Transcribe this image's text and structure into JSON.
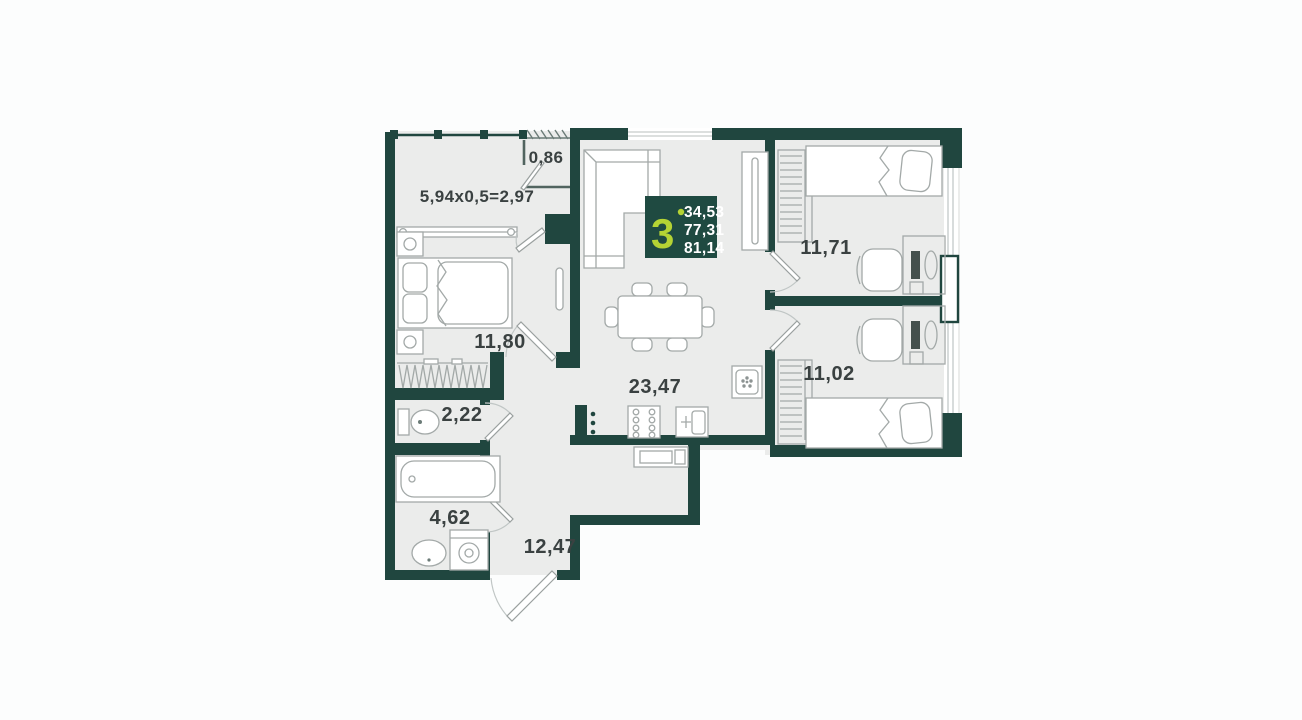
{
  "plan_title": "3-room apartment floor plan",
  "badge": {
    "rooms_count": "3",
    "areas": [
      "34,53",
      "77,31",
      "81,14"
    ]
  },
  "rooms": {
    "balcony": {
      "label": "5,94x0,5=2,97"
    },
    "storage": {
      "label": "0,86"
    },
    "bedroom": {
      "label": "11,80"
    },
    "wc": {
      "label": "2,22"
    },
    "bathroom": {
      "label": "4,62"
    },
    "hallway": {
      "label": "12,47"
    },
    "living_kitchen": {
      "label": "23,47"
    },
    "bedroom2": {
      "label": "11,71"
    },
    "bedroom3": {
      "label": "11,02"
    }
  },
  "colors": {
    "wall": "#20463f",
    "floor": "#ebeceb",
    "badge_bg": "#1f4a41",
    "accent": "#b5d334",
    "text": "#3a4141",
    "furniture_stroke": "#a3a9a8",
    "background": "#fcfdfd"
  }
}
